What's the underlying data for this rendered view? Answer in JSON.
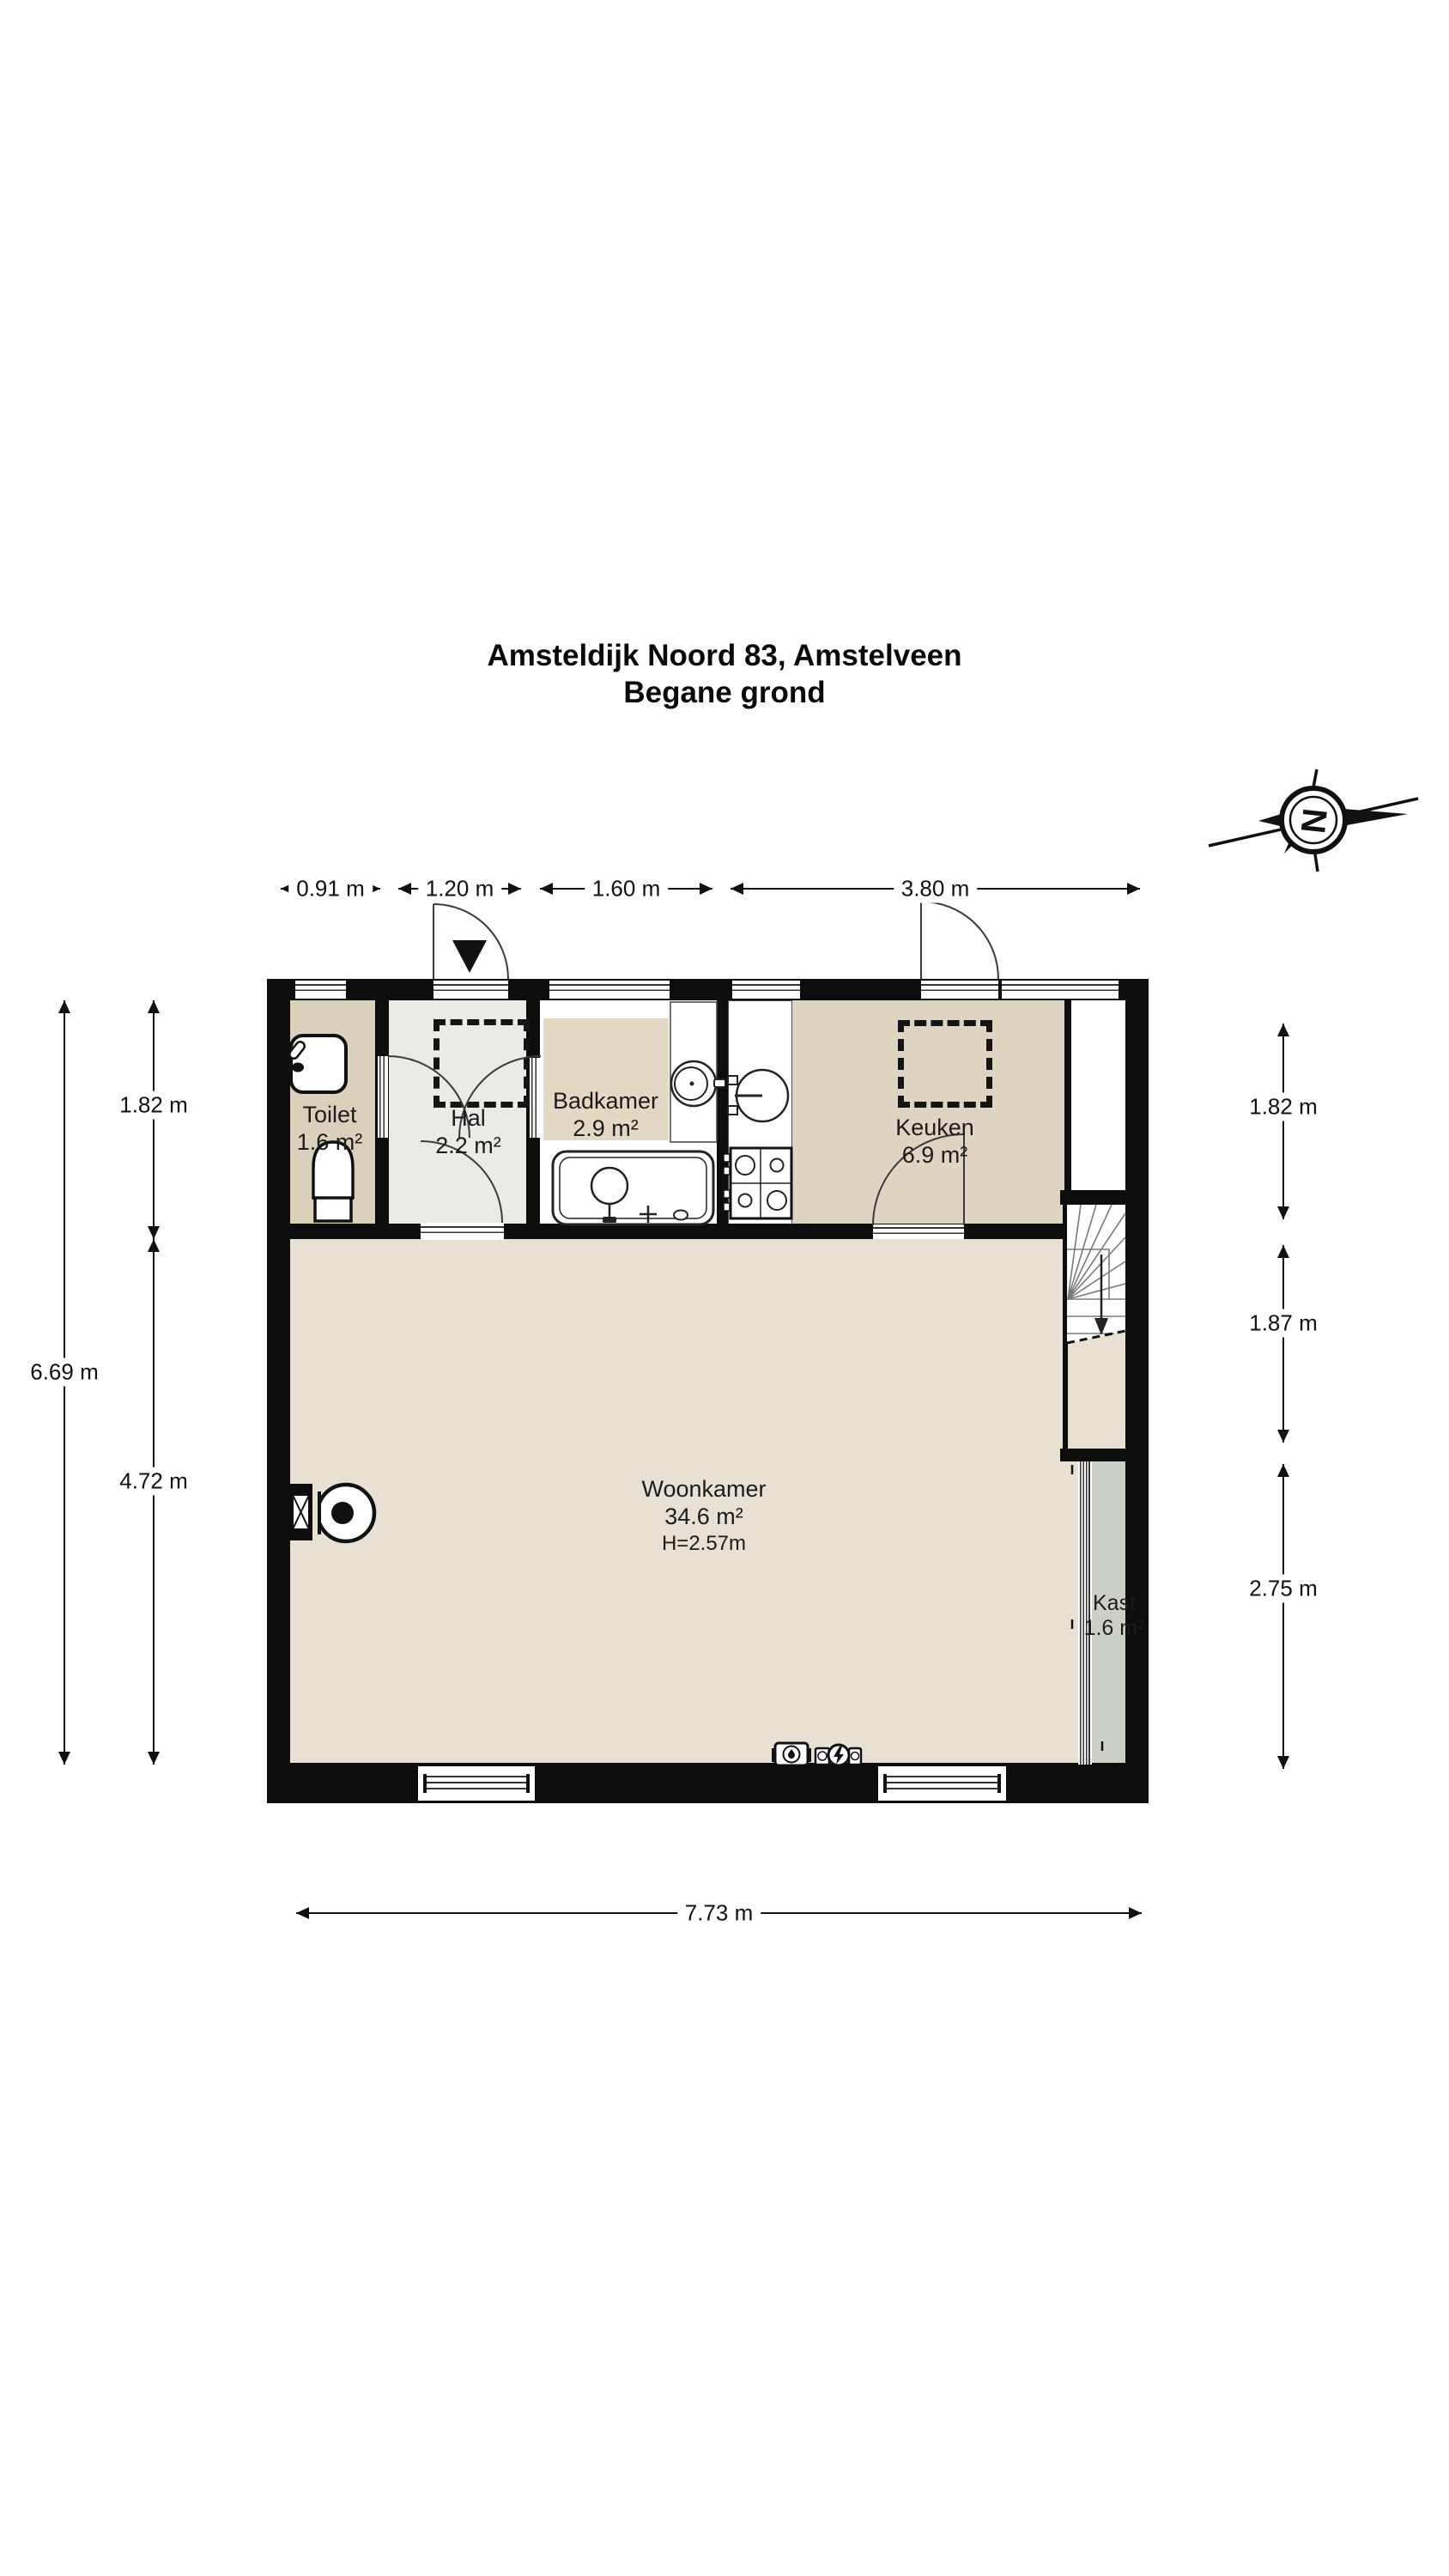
{
  "title": {
    "line1": "Amsteldijk Noord 83, Amstelveen",
    "line2": "Begane grond"
  },
  "compass": {
    "letter": "N",
    "icon": "compass-north-icon"
  },
  "rooms": {
    "toilet": {
      "name": "Toilet",
      "area": "1.6 m²"
    },
    "hal": {
      "name": "Hal",
      "area": "2.2 m²"
    },
    "badkamer": {
      "name": "Badkamer",
      "area": "2.9 m²"
    },
    "keuken": {
      "name": "Keuken",
      "area": "6.9 m²"
    },
    "woonkamer": {
      "name": "Woonkamer",
      "area": "34.6 m²",
      "height": "H=2.57m"
    },
    "kast": {
      "name": "Kast",
      "area": "1.6 m²"
    }
  },
  "dimensions": {
    "top": [
      "0.91 m",
      "1.20 m",
      "1.60 m",
      "3.80 m"
    ],
    "left_inner": [
      "1.82 m",
      "4.72 m"
    ],
    "left_total": "6.69 m",
    "right": [
      "1.82 m",
      "1.87 m",
      "2.75 m"
    ],
    "bottom": "7.73 m"
  },
  "icons": {
    "compass": "compass-north-icon",
    "entrance_marker": "entrance-arrow-icon",
    "water_meter": "water-meter-icon",
    "electric_meter": "electric-meter-icon",
    "stairs_direction": "stairs-down-arrow-icon"
  },
  "colors": {
    "wall": "#0d0d0d",
    "woonkamer_floor": "#e8e1d3",
    "toilet_floor": "#dbd0bc",
    "badkamer_floor": "#e2d8c4",
    "keuken_floor": "#ded4c1",
    "hal_floor": "#ebeae5",
    "kast_floor": "#cbd0c7",
    "fixture_white": "#ffffff"
  }
}
